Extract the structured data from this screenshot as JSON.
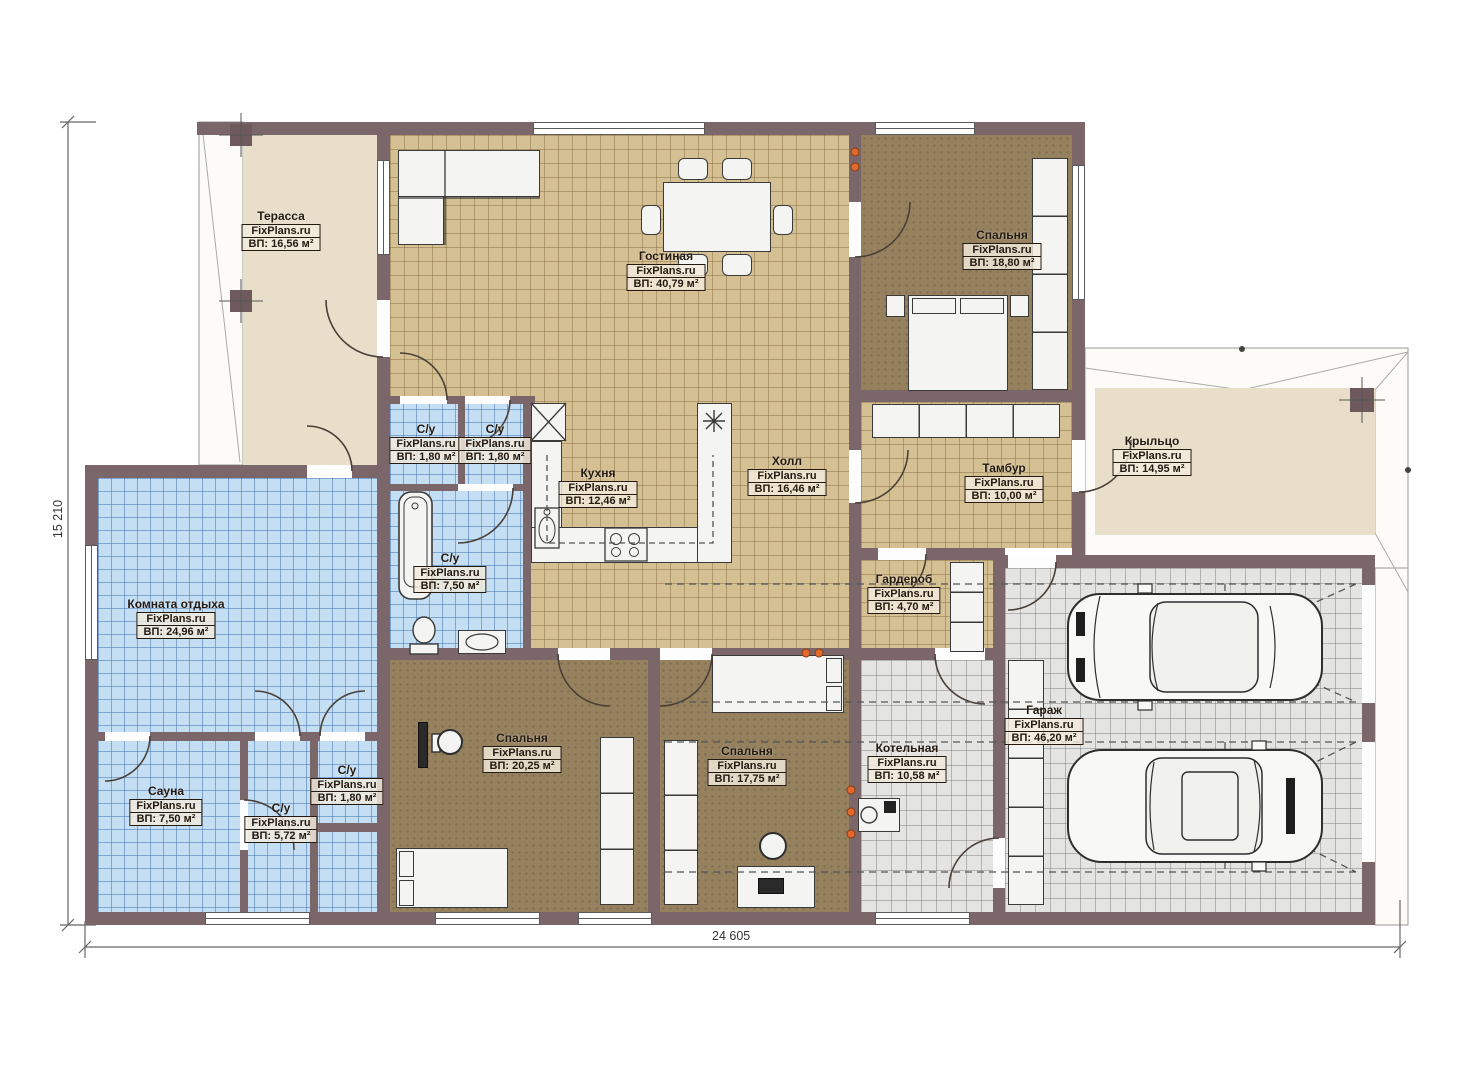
{
  "plan": {
    "watermark": "FixPlans.ru",
    "dim_height": "15 210",
    "dim_width": "24 605",
    "colors": {
      "wall": "#7b6769",
      "tile_tan": "#d5c094",
      "tile_blue": "#c4def4",
      "tile_gray": "#e4e4e2",
      "floor_brown": "#96815f",
      "floor_beige": "#e8deca",
      "radiator_orange": "#e2692e"
    },
    "rooms": [
      {
        "key": "terrace",
        "name": "Терасса",
        "area": "ВП: 16,56 м²"
      },
      {
        "key": "living",
        "name": "Гостиная",
        "area": "ВП: 40,79 м²"
      },
      {
        "key": "bedroom-top",
        "name": "Спальня",
        "area": "ВП: 18,80 м²"
      },
      {
        "key": "wc-1",
        "name": "С/у",
        "area": "ВП: 1,80 м²"
      },
      {
        "key": "wc-2",
        "name": "С/у",
        "area": "ВП: 1,80 м²"
      },
      {
        "key": "kitchen",
        "name": "Кухня",
        "area": "ВП: 12,46 м²"
      },
      {
        "key": "hall",
        "name": "Холл",
        "area": "ВП: 16,46 м²"
      },
      {
        "key": "vestibule",
        "name": "Тамбур",
        "area": "ВП: 10,00 м²"
      },
      {
        "key": "porch",
        "name": "Крыльцо",
        "area": "ВП: 14,95 м²"
      },
      {
        "key": "wardrobe",
        "name": "Гардероб",
        "area": "ВП: 4,70 м²"
      },
      {
        "key": "bathroom",
        "name": "С/у",
        "area": "ВП: 7,50 м²"
      },
      {
        "key": "lounge",
        "name": "Комната отдыха",
        "area": "ВП: 24,96 м²"
      },
      {
        "key": "sauna",
        "name": "Сауна",
        "area": "ВП: 7,50 м²"
      },
      {
        "key": "wc-3",
        "name": "С/у",
        "area": "ВП: 5,72 м²"
      },
      {
        "key": "wc-4",
        "name": "С/у",
        "area": "ВП: 1,80 м²"
      },
      {
        "key": "bedroom-1",
        "name": "Спальня",
        "area": "ВП: 20,25 м²"
      },
      {
        "key": "bedroom-2",
        "name": "Спальня",
        "area": "ВП: 17,75 м²"
      },
      {
        "key": "boiler",
        "name": "Котельная",
        "area": "ВП: 10,58 м²"
      },
      {
        "key": "garage",
        "name": "Гараж",
        "area": "ВП: 46,20 м²"
      }
    ]
  }
}
